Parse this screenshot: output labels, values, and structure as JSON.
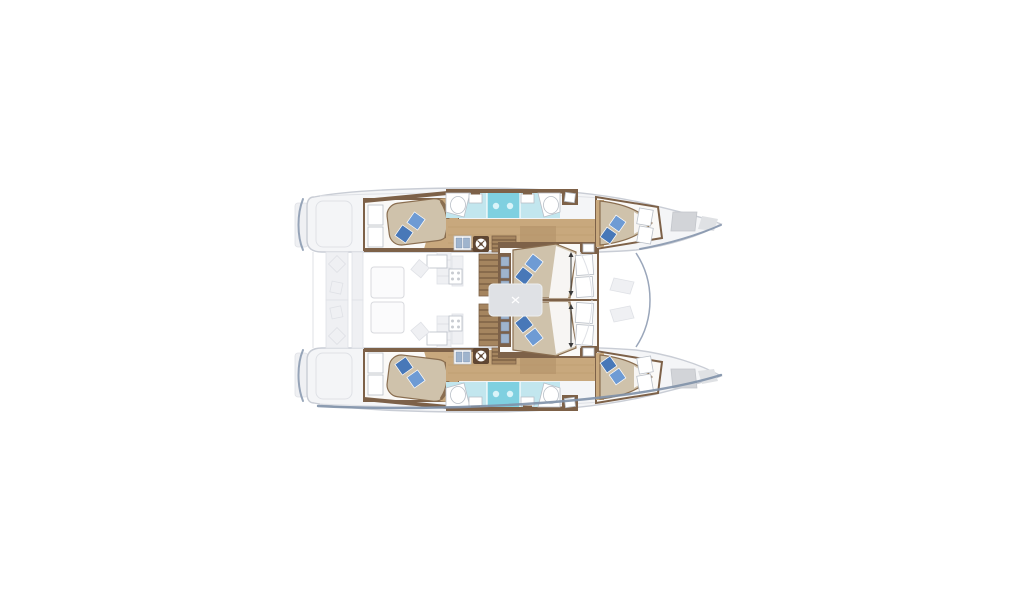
{
  "meta": {
    "title": "Catamaran yacht floor plan — top-down deck layout with six double cabins",
    "image_type": "boat layout diagram",
    "orientation": "bow pointing right, stern at left, mirror-symmetric hulls",
    "background": "#ffffff"
  },
  "colors": {
    "hull_fill": "#f4f5f7",
    "hull_stroke": "#c9cdd5",
    "hull_shadow": "#8091a9",
    "ghost_fill": "#eff0f3",
    "ghost_stroke": "#dfe1e6",
    "wall_brown": "#7d6148",
    "wood_dark": "#8a6e50",
    "wood_floor": "#c8a87d",
    "wood_light": "#a5855f",
    "bed_fill": "#cfc2ab",
    "bed_trim": "#8a6e50",
    "sheet_white": "#fbfaf8",
    "pillow_dark": "#4878b8",
    "pillow_light": "#6e9bd4",
    "bath_floor": "#c2e6ee",
    "shower_fill": "#7fd0e0",
    "shower_glow": "#dff6fa",
    "fixture_white": "#ffffff",
    "fixture_stroke": "#b9bfc7",
    "drawer_blue": "#9fb4cd",
    "washer_body": "#5f4632",
    "arrow_dark": "#3a3a3a",
    "cabin_floor": "#faf9f7",
    "deck_line": "#9aa6ba"
  },
  "vessel": {
    "style": "sailing catamaran",
    "hulls": [
      {
        "id": "port",
        "position": "top half of drawing"
      },
      {
        "id": "starboard",
        "position": "bottom half of drawing"
      }
    ],
    "cabins": [
      {
        "id": "port-aft",
        "beds": 1,
        "pillows": 2,
        "features": [
          "wardrobe",
          "wood sole"
        ]
      },
      {
        "id": "port-forward",
        "beds": 1,
        "pillows": 2,
        "features": [
          "wardrobe"
        ]
      },
      {
        "id": "mid-port",
        "beds": 1,
        "pillows": 2,
        "features": [
          "wardrobe",
          "drawers",
          "length arrow"
        ]
      },
      {
        "id": "mid-starboard",
        "beds": 1,
        "pillows": 2,
        "features": [
          "wardrobe",
          "drawers",
          "length arrow"
        ]
      },
      {
        "id": "starboard-aft",
        "beds": 1,
        "pillows": 2,
        "features": [
          "wardrobe",
          "wood sole"
        ]
      },
      {
        "id": "starboard-forward",
        "beds": 1,
        "pillows": 2,
        "features": [
          "wardrobe"
        ]
      }
    ],
    "bathrooms": [
      {
        "id": "port-heads",
        "fixtures": [
          "sink",
          "toilet",
          "central shower",
          "sink",
          "toilet"
        ]
      },
      {
        "id": "starboard-heads",
        "fixtures": [
          "sink",
          "toilet",
          "central shower",
          "sink",
          "toilet"
        ]
      }
    ],
    "common_areas": [
      "aft cockpit with table and bench",
      "salon table",
      "galley",
      "hull corridors",
      "foredeck",
      "bow deck hatches",
      "swim steps"
    ],
    "equipment": [
      {
        "id": "washing-machine",
        "count": 2
      },
      {
        "id": "staircase",
        "count": 2
      }
    ]
  }
}
